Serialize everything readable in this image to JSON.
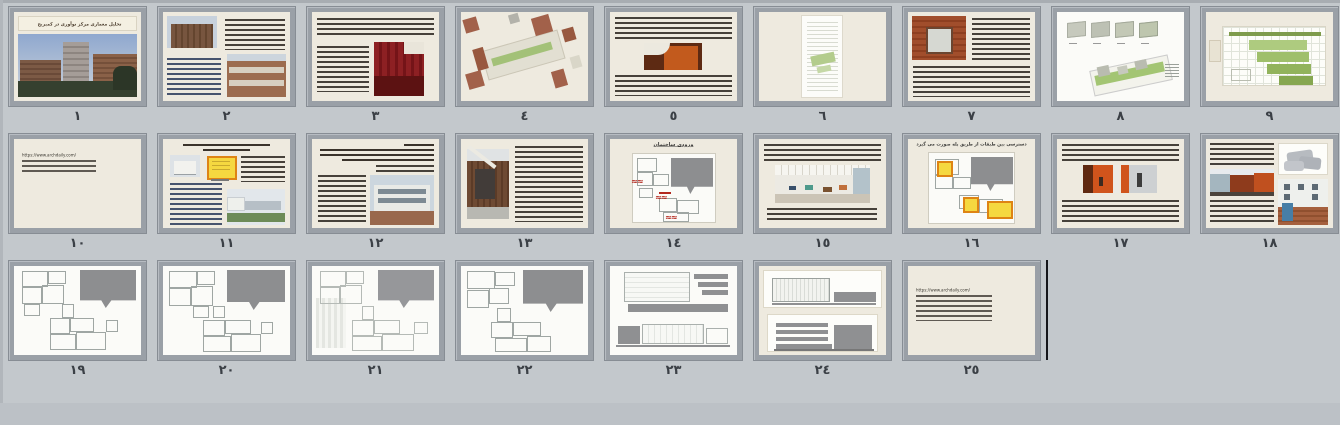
{
  "view": {
    "name": "presentation-slide-sorter",
    "slide_count": 25,
    "background_color": "#c3c8cc",
    "thumbnail_frame_color": "#9aa0a7",
    "slide_paper_color": "#eeeadf",
    "accent_colors": {
      "highlight_yellow": "#f5d840",
      "highlight_orange_border": "#de8414",
      "arrow_red": "#b3281e",
      "landscape_green": "#9fbf6b",
      "brick_orange": "#a2614a",
      "plan_mass_gray": "#8d8e90"
    }
  },
  "slides": [
    {
      "number": "١",
      "title": "تحلیل معماری مرکز نوآوری در کمبریج",
      "kind": "title-with-photo"
    },
    {
      "number": "٢",
      "kind": "specs-and-photos"
    },
    {
      "number": "٣",
      "kind": "text-with-red-interior-photo"
    },
    {
      "number": "٤",
      "kind": "exploded-axonometric"
    },
    {
      "number": "٥",
      "kind": "text-with-orange-interior-photo"
    },
    {
      "number": "٦",
      "kind": "vertical-diagram-panel"
    },
    {
      "number": "٧",
      "kind": "facade-photo-with-text"
    },
    {
      "number": "٨",
      "kind": "massing-diagrams-site-axon"
    },
    {
      "number": "٩",
      "kind": "green-step-diagram"
    },
    {
      "number": "١٠",
      "url": "https://www.archdaily.com/",
      "kind": "source-link"
    },
    {
      "number": "١١",
      "kind": "plan-highlight-and-photos"
    },
    {
      "number": "١٢",
      "kind": "site-text-with-photo"
    },
    {
      "number": "١٣",
      "kind": "entrance-photo-with-text"
    },
    {
      "number": "١٤",
      "title": "ورودی ساختمان",
      "kind": "entrance-plan-red-arrows"
    },
    {
      "number": "١٥",
      "kind": "text-with-office-photo"
    },
    {
      "number": "١٦",
      "title": "دسترسی بین طبقات از طریق پله صورت می گیرد",
      "kind": "plan-yellow-highlights"
    },
    {
      "number": "١٧",
      "kind": "text-with-two-interior-photos"
    },
    {
      "number": "١٨",
      "kind": "massing-courtyard-facade-photos"
    },
    {
      "number": "١٩",
      "kind": "floor-plan"
    },
    {
      "number": "٢٠",
      "kind": "floor-plan"
    },
    {
      "number": "٢١",
      "kind": "floor-plan"
    },
    {
      "number": "٢٢",
      "kind": "floor-plan"
    },
    {
      "number": "٢٣",
      "kind": "elevations"
    },
    {
      "number": "٢٤",
      "kind": "elevations"
    },
    {
      "number": "٢٥",
      "url": "https://www.archdaily.com/",
      "kind": "source-link"
    }
  ]
}
